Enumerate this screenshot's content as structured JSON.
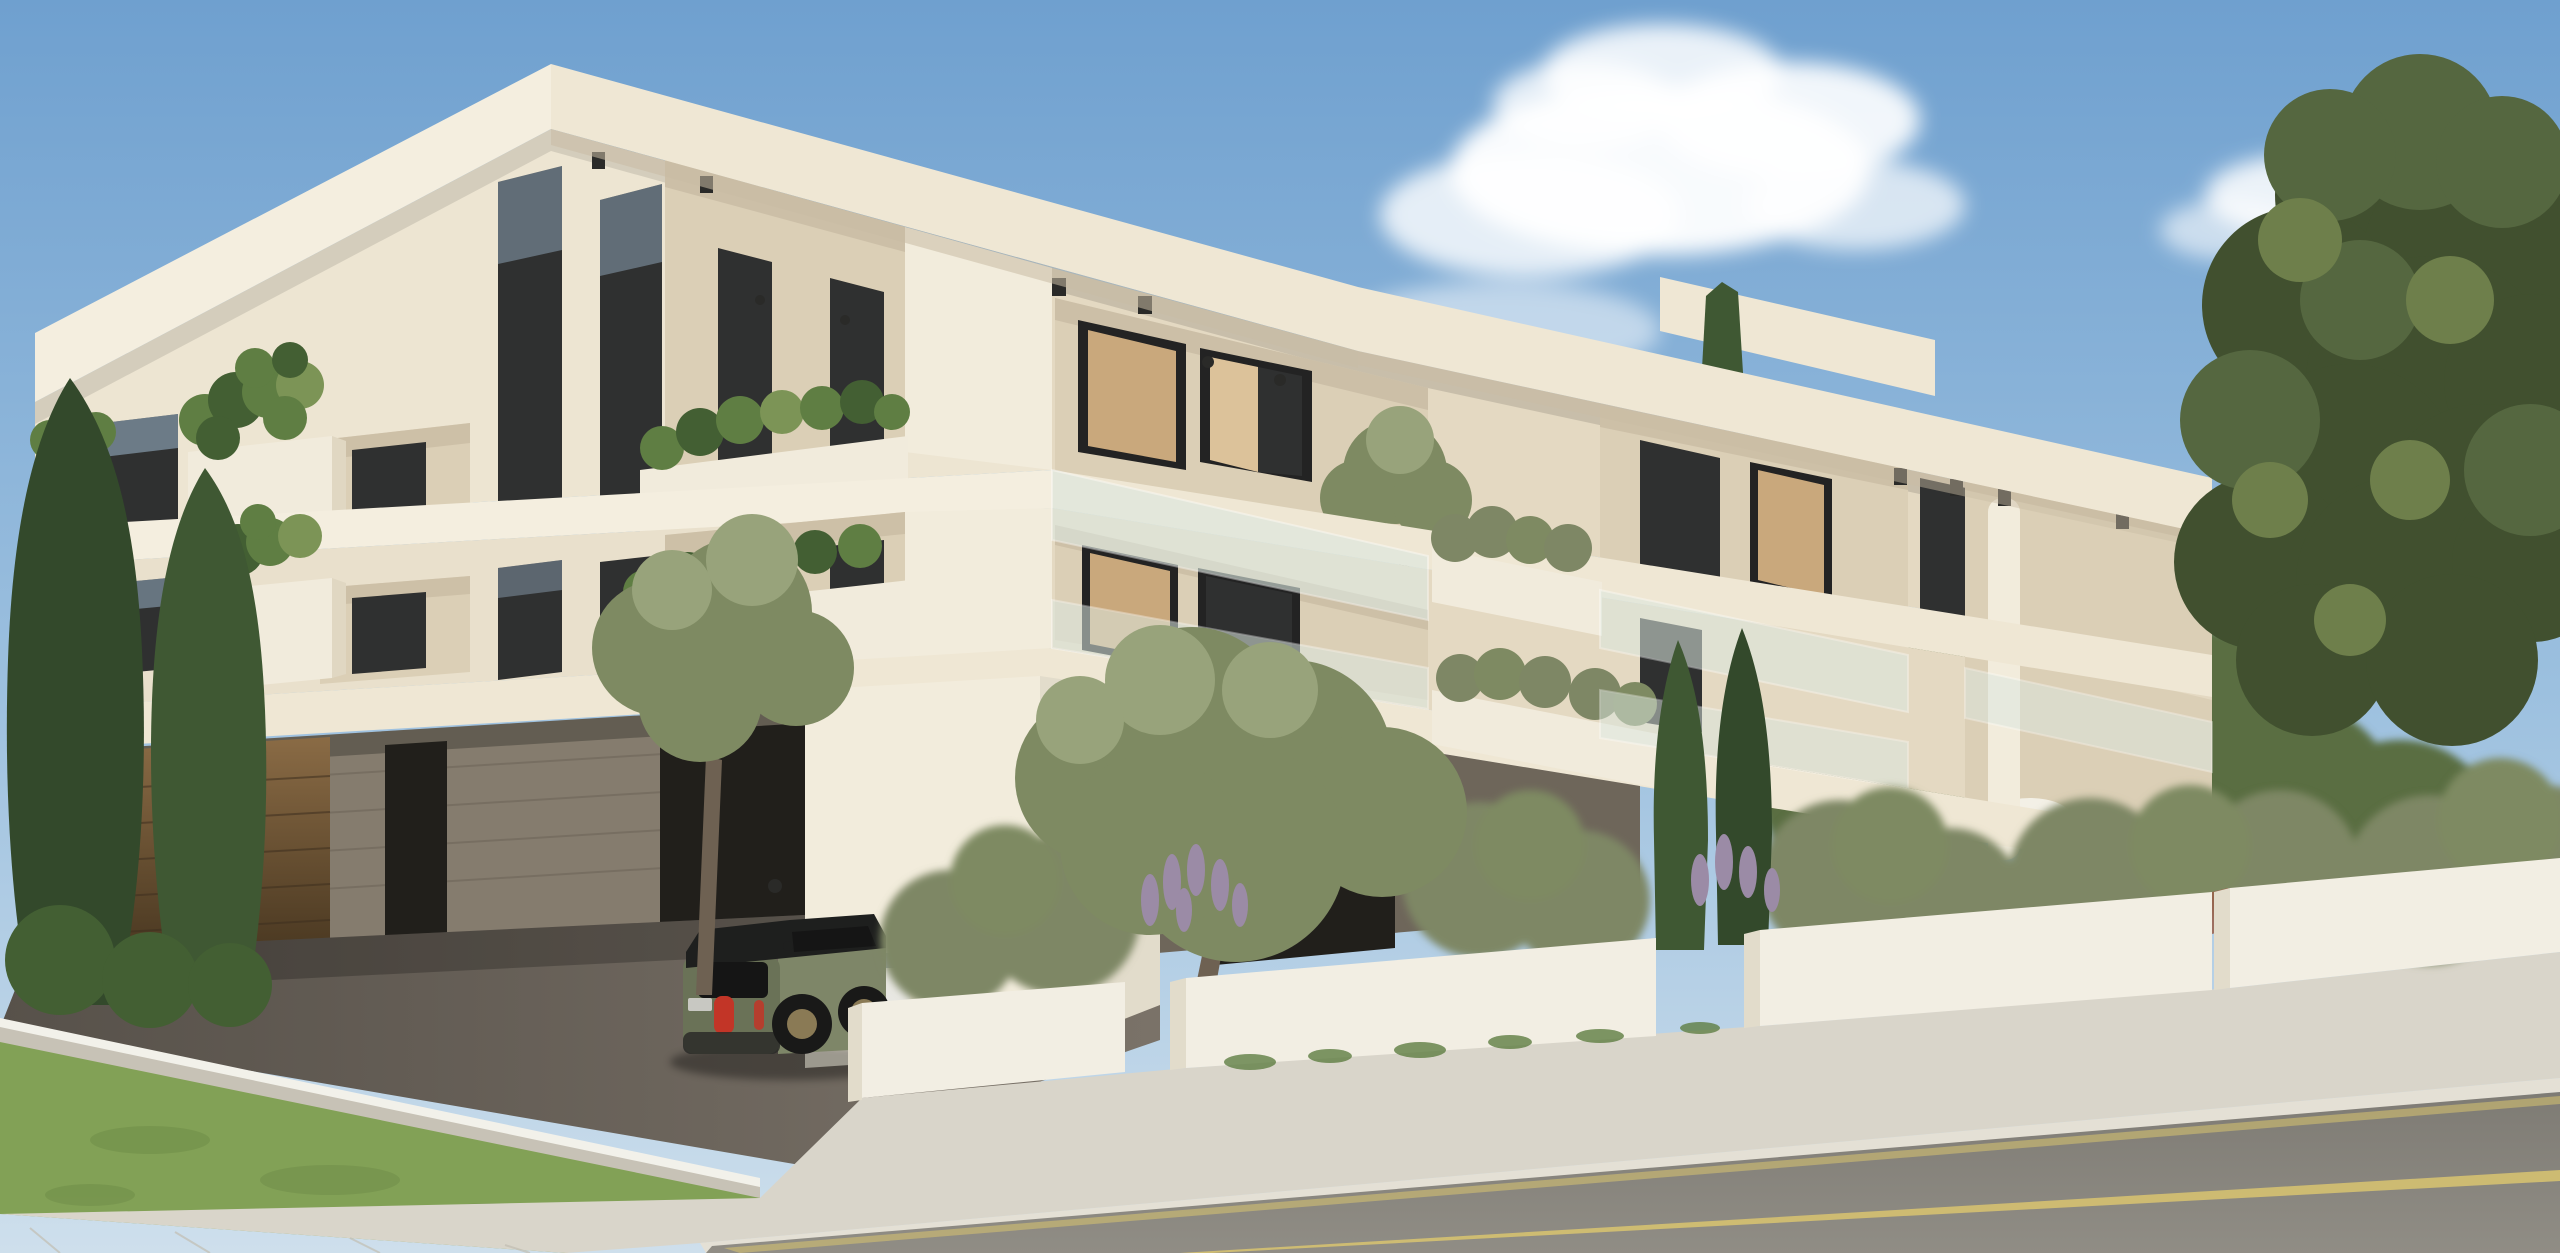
{
  "scene": {
    "type": "architectural-render",
    "subject": "modern two-storey white apartment building with roof overhangs, planted balconies, under-croft parking, street and garden walls",
    "elements": [
      "sky",
      "clouds",
      "apartment-building",
      "roof-slab",
      "balconies",
      "glass-balustrades",
      "planter-boxes",
      "garage",
      "wooden-garage-door",
      "green-mini-suv",
      "silver-car",
      "white-car",
      "cypress-trees",
      "olive-trees",
      "pine-tree",
      "garden-walls",
      "lavender",
      "shrubs",
      "lawn",
      "sidewalk",
      "asphalt-road",
      "road-markings"
    ],
    "colors": {
      "sky_top": "#6FA0CF",
      "sky_mid": "#9CC0DF",
      "sky_horizon": "#CEDFEC",
      "cloud_white": "#FFFFFF",
      "fascia_bright": "#F4EEDF",
      "fascia_light": "#EFE7D4",
      "wall_left": "#EDE5D2",
      "wall_left_lower": "#E9E0CC",
      "wall_right": "#E4D9C2",
      "pier_white": "#F2ECDC",
      "soffit_shadow": "#C9BCA4",
      "recess_wall": "#DBCFB6",
      "glass_dark": "#2F3030",
      "glass_sky": "#9FB9CF",
      "glass_frame": "#232323",
      "curtain": "#C9A87C",
      "curtain_light": "#DCC29A",
      "balustrade_glass": "#DCE8E0",
      "planter_white": "#F1EBDC",
      "planter_shadow": "#E0D7C2",
      "shrub_dark": "#435F33",
      "shrub_mid": "#5F7E43",
      "shrub_light": "#7C9456",
      "shrub_gray": "#7E8765",
      "olive_canopy": "#7E8A62",
      "olive_light": "#98A37B",
      "olive_trunk": "#6E6152",
      "cypress_dark": "#33492B",
      "cypress_mid": "#3F5833",
      "pine_dark": "#41502F",
      "pine_mid": "#556740",
      "pine_light": "#6E7F4B",
      "pine_trunk": "#5E4C39",
      "tree_back": "#5A6E42",
      "lavender": "#9B8BA6",
      "concrete": "#857C6E",
      "concrete_dark": "#6E665A",
      "garage_opening": "#211F1B",
      "wood_door_light": "#8A6B45",
      "wood_door_dark": "#46351F",
      "drive_floor": "#57514A",
      "drive_light": "#7A7268",
      "curb_face": "#C7C2B6",
      "curb_line": "#F2F1EA",
      "grass": "#82A156",
      "grass_dark": "#6E8C47",
      "sidewalk": "#D9D5CA",
      "sidewalk_lip": "#E4E0D5",
      "road": "#908D85",
      "road_dark": "#7E7B74",
      "road_line": "#D9C470",
      "wall_front": "#F2EEE3",
      "wall_side": "#E2DCCB",
      "car_green": "#7E8668",
      "car_green_dark": "#6A7257",
      "car_roof": "#1E1F1E",
      "car_glass": "#151515",
      "tail_red": "#C23527",
      "wheel_dark": "#191918",
      "rim_bronze": "#8A7A55",
      "plate": "#C8C8C2",
      "car_silver": "#B9BAB8",
      "car_white": "#E8E7E2",
      "lamp_black": "#2A2A28",
      "distant_roof": "#9A5F4A"
    }
  }
}
